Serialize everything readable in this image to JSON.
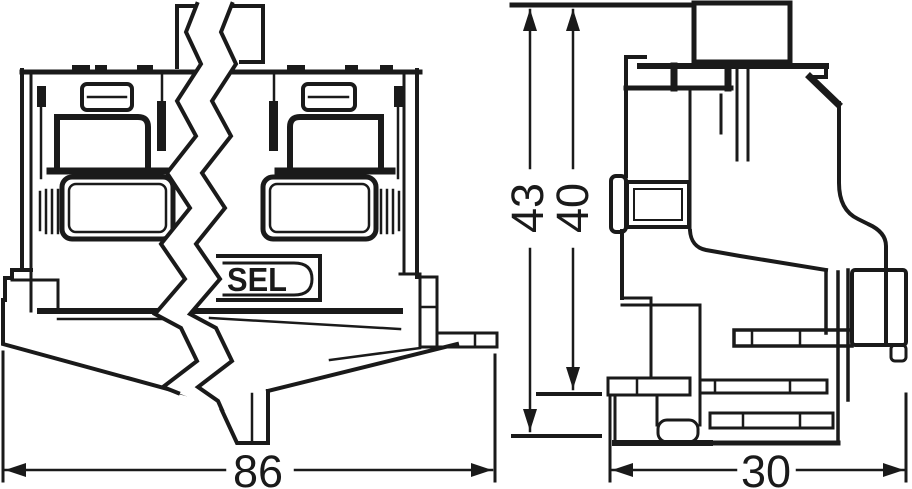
{
  "drawing": {
    "kind": "technical-dimensional-drawing",
    "front_view": {
      "brand_label": "SEL"
    },
    "dimensions": {
      "overall_width": {
        "value": "86",
        "orientation": "horizontal",
        "view": "front"
      },
      "total_height": {
        "value": "43",
        "orientation": "vertical",
        "view": "side"
      },
      "body_height": {
        "value": "40",
        "orientation": "vertical",
        "view": "side"
      },
      "depth": {
        "value": "30",
        "orientation": "horizontal",
        "view": "side"
      }
    },
    "colors": {
      "line": "#1a1a1a",
      "background": "#ffffff"
    }
  }
}
